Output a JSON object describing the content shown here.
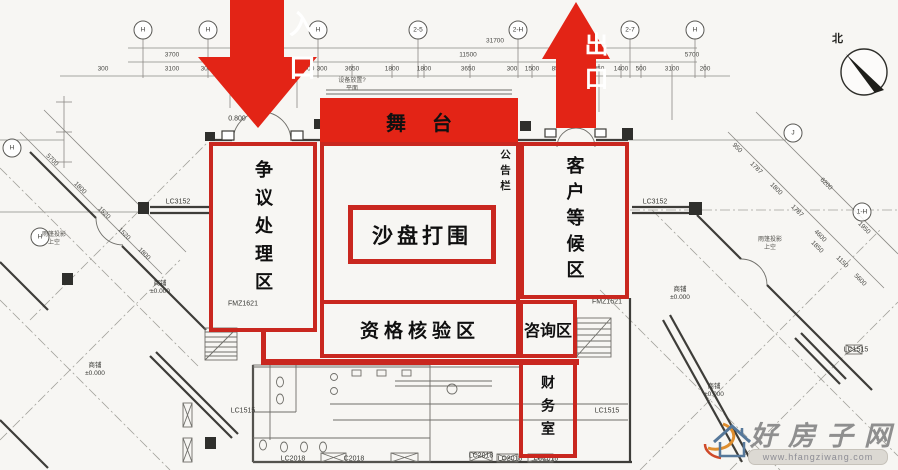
{
  "colors": {
    "overlay": "#c9271f",
    "arrow": "#e32416",
    "ink": "#141412"
  },
  "zones": {
    "entrance": {
      "label": "入口"
    },
    "exit": {
      "label": "出口"
    },
    "stage": {
      "label": "舞台"
    },
    "dispute": {
      "label": "争议处理区"
    },
    "sandtable": {
      "label": "沙盘打围"
    },
    "waiting": {
      "label": "客户等候区"
    },
    "bulletin": {
      "label": "公告栏"
    },
    "verify": {
      "label": "资格核验区"
    },
    "consult": {
      "label": "咨询区"
    },
    "finance": {
      "label": "财务室"
    }
  },
  "compass": {
    "north_label": "北"
  },
  "watermark": {
    "name": "好房子网",
    "url": "www.hfangziwang.com"
  },
  "grid_bubbles": [
    {
      "t": "H",
      "x": 143,
      "y": 30
    },
    {
      "t": "H",
      "x": 208,
      "y": 30
    },
    {
      "t": "H",
      "x": 318,
      "y": 30
    },
    {
      "t": "2-5",
      "x": 418,
      "y": 30
    },
    {
      "t": "2-H",
      "x": 518,
      "y": 30
    },
    {
      "t": "2-7",
      "x": 630,
      "y": 30
    },
    {
      "t": "H",
      "x": 695,
      "y": 30
    },
    {
      "t": "J",
      "x": 793,
      "y": 133
    },
    {
      "t": "1-H",
      "x": 862,
      "y": 212
    },
    {
      "t": "H",
      "x": 12,
      "y": 148
    },
    {
      "t": "H",
      "x": 40,
      "y": 237
    }
  ],
  "dims_top": [
    {
      "t": "31700",
      "x": 495,
      "y": 41
    },
    {
      "t": "11500",
      "x": 468,
      "y": 55
    },
    {
      "t": "3700",
      "x": 172,
      "y": 55
    },
    {
      "t": "5700",
      "x": 692,
      "y": 55
    },
    {
      "t": "300",
      "x": 103,
      "y": 69
    },
    {
      "t": "3100",
      "x": 172,
      "y": 69
    },
    {
      "t": "300",
      "x": 206,
      "y": 69
    },
    {
      "t": "1400",
      "x": 228,
      "y": 69
    },
    {
      "t": "600",
      "x": 295,
      "y": 69
    },
    {
      "t": "900",
      "x": 309,
      "y": 69
    },
    {
      "t": "300",
      "x": 322,
      "y": 69
    },
    {
      "t": "3650",
      "x": 352,
      "y": 69
    },
    {
      "t": "1800",
      "x": 392,
      "y": 69
    },
    {
      "t": "1800",
      "x": 424,
      "y": 69
    },
    {
      "t": "3650",
      "x": 468,
      "y": 69
    },
    {
      "t": "300",
      "x": 512,
      "y": 69
    },
    {
      "t": "1500",
      "x": 532,
      "y": 69
    },
    {
      "t": "850",
      "x": 557,
      "y": 69
    },
    {
      "t": "850",
      "x": 599,
      "y": 69
    },
    {
      "t": "1400",
      "x": 621,
      "y": 69
    },
    {
      "t": "500",
      "x": 641,
      "y": 69
    },
    {
      "t": "3100",
      "x": 672,
      "y": 69
    },
    {
      "t": "200",
      "x": 705,
      "y": 69
    }
  ],
  "dims_diag": [
    {
      "t": "5700",
      "x": 52,
      "y": 160,
      "r": 45
    },
    {
      "t": "1800",
      "x": 80,
      "y": 188,
      "r": 45
    },
    {
      "t": "1520",
      "x": 104,
      "y": 213,
      "r": 45
    },
    {
      "t": "1520",
      "x": 124,
      "y": 234,
      "r": 45
    },
    {
      "t": "1800",
      "x": 144,
      "y": 254,
      "r": 45
    },
    {
      "t": "950",
      "x": 737,
      "y": 148,
      "r": 45
    },
    {
      "t": "1787",
      "x": 756,
      "y": 168,
      "r": 45
    },
    {
      "t": "1800",
      "x": 776,
      "y": 189,
      "r": 45
    },
    {
      "t": "1787",
      "x": 797,
      "y": 211,
      "r": 45
    },
    {
      "t": "4600",
      "x": 820,
      "y": 236,
      "r": 45
    },
    {
      "t": "6200",
      "x": 826,
      "y": 184,
      "r": 45
    },
    {
      "t": "1950",
      "x": 864,
      "y": 228,
      "r": 45
    },
    {
      "t": "1850",
      "x": 817,
      "y": 247,
      "r": 45
    },
    {
      "t": "1150",
      "x": 842,
      "y": 262,
      "r": 45
    },
    {
      "t": "5600",
      "x": 860,
      "y": 280,
      "r": 45
    }
  ],
  "plan_labels": [
    {
      "t": "LC3152",
      "x": 178,
      "y": 202
    },
    {
      "t": "LC3152",
      "x": 655,
      "y": 202
    },
    {
      "t": "FMZ1621",
      "x": 243,
      "y": 304
    },
    {
      "t": "FMZ1621",
      "x": 607,
      "y": 302
    },
    {
      "t": "LC1515",
      "x": 243,
      "y": 411
    },
    {
      "t": "LC1515",
      "x": 607,
      "y": 411
    },
    {
      "t": "LC1515",
      "x": 856,
      "y": 350
    },
    {
      "t": "LC2018",
      "x": 293,
      "y": 459
    },
    {
      "t": "C2018",
      "x": 354,
      "y": 459
    },
    {
      "t": "LC2018",
      "x": 481,
      "y": 456
    },
    {
      "t": "LC2018",
      "x": 510,
      "y": 459
    },
    {
      "t": "LC2018",
      "x": 546,
      "y": 459
    },
    {
      "t": "0.800",
      "x": 237,
      "y": 119
    }
  ],
  "level_marks": [
    {
      "t": "商铺\n±0.000",
      "x": 160,
      "y": 288
    },
    {
      "t": "商铺\n±0.000",
      "x": 95,
      "y": 370
    },
    {
      "t": "商铺\n±0.000",
      "x": 680,
      "y": 294
    },
    {
      "t": "商铺\n±0.000",
      "x": 714,
      "y": 391
    }
  ],
  "tiny_notes": [
    {
      "t": "设备放置?\n平面",
      "x": 352,
      "y": 86
    },
    {
      "t": "雨篷投影\n上空",
      "x": 54,
      "y": 240
    },
    {
      "t": "雨篷投影\n上空",
      "x": 770,
      "y": 245
    }
  ]
}
